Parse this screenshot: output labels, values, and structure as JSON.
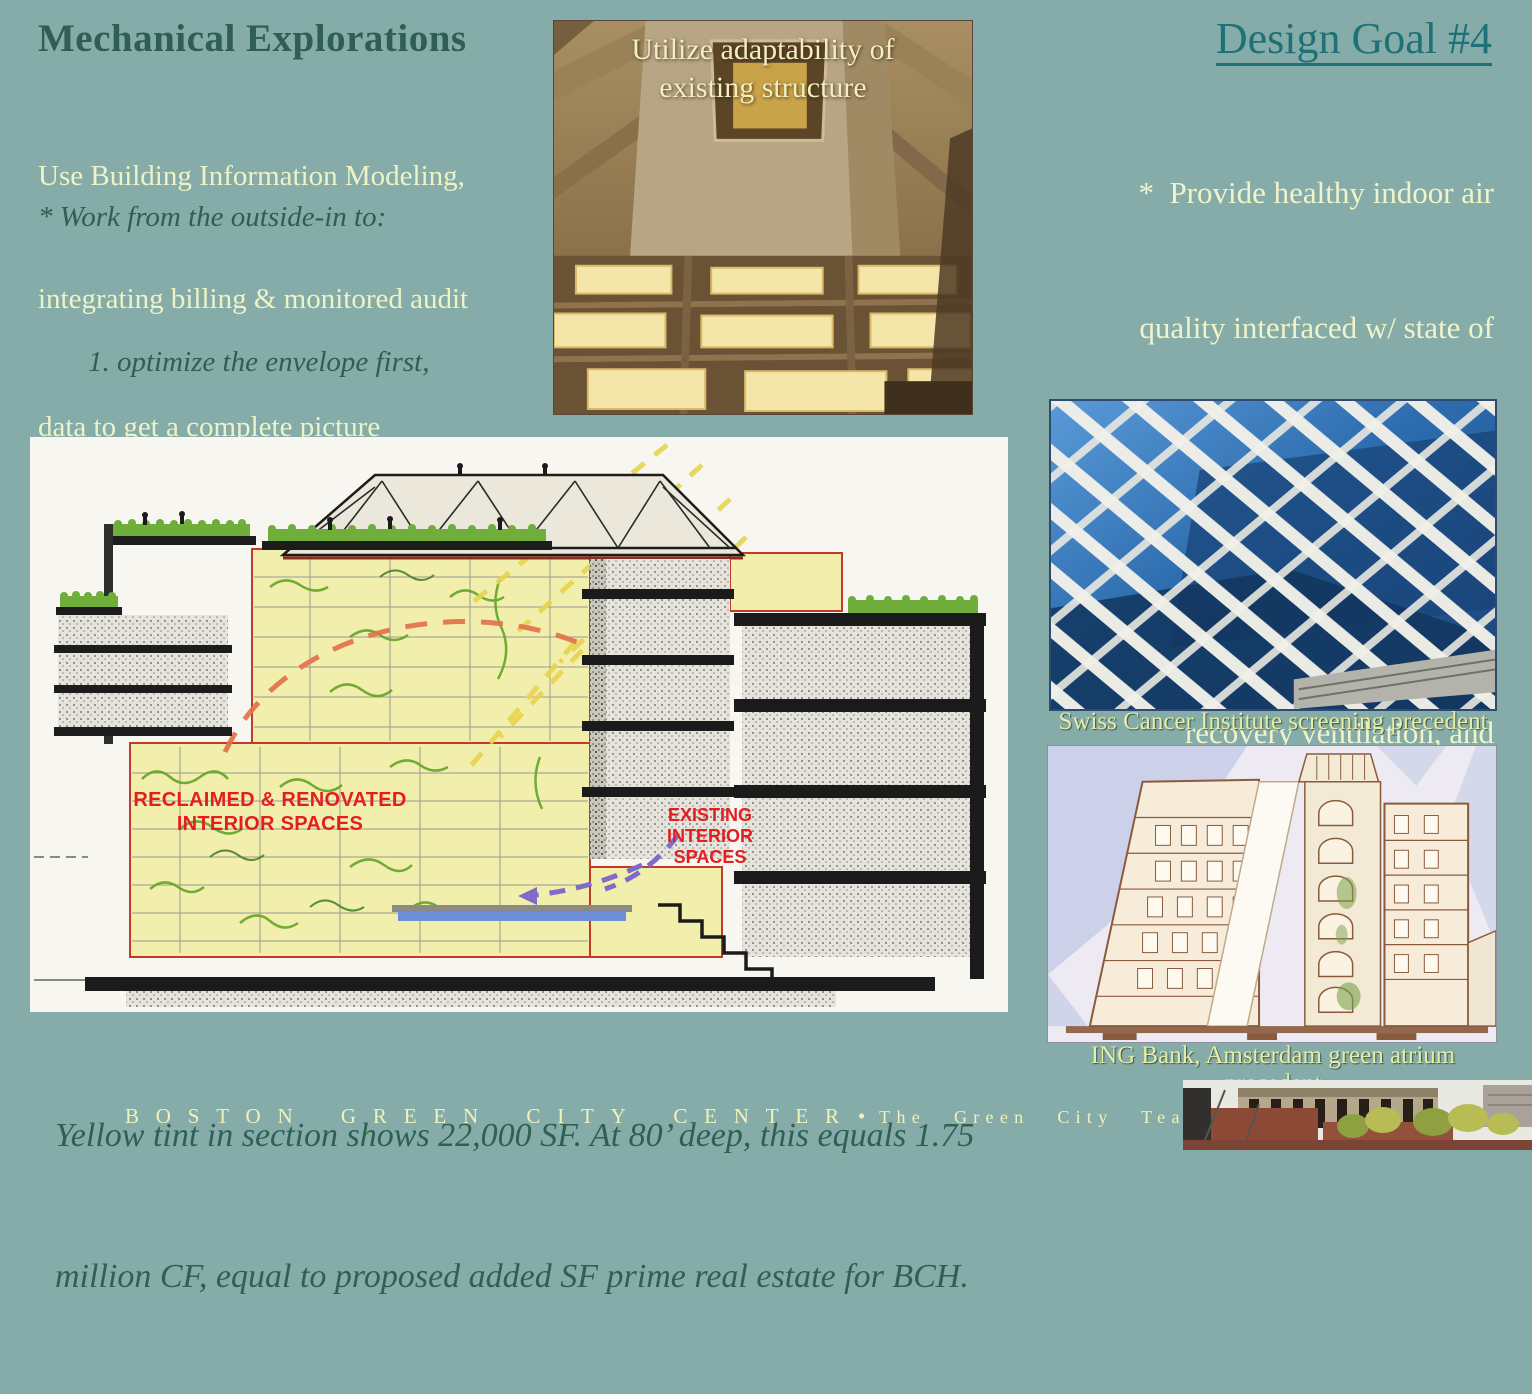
{
  "left_column": {
    "title": "Mechanical Explorations",
    "intro_lines": [
      "Use Building Information Modeling,",
      "integrating billing & monitored audit",
      "data to get a complete picture"
    ],
    "work_note": "* Work from the outside-in to:",
    "list_items": [
      "1. optimize the envelope first,",
      "2.  then lighting,",
      "3. then redesign delivery system,",
      "4.  then equipment."
    ]
  },
  "structure_photo": {
    "caption_lines": [
      "Utilize adaptability of",
      "existing structure"
    ]
  },
  "right_column": {
    "title": "Design Goal #4",
    "body_lines": [
      "*  Provide healthy indoor air",
      "quality interfaced w/ state of",
      "the art mechanical upgrades.",
      "Passive stack effect, heat",
      "recovery ventilation, and",
      "future district heating options",
      "offer synchronistic savings."
    ],
    "swiss_caption": "Swiss Cancer Institute screening precedent",
    "ing_caption": "ING Bank, Amsterdam green atrium precedent"
  },
  "section_drawing": {
    "reclaimed_label_lines": [
      "RECLAIMED & RENOVATED",
      "INTERIOR SPACES"
    ],
    "existing_label_lines": [
      "EXISTING",
      "INTERIOR",
      "SPACES"
    ]
  },
  "bottom_caption_lines": [
    "Yellow tint in section shows 22,000 SF. At 80’ deep, this equals 1.75",
    "million CF, equal to proposed added SF prime real estate for BCH."
  ],
  "footer": {
    "left": "BOSTON GREEN CITY CENTER",
    "separator": "•",
    "right": "The Green City Team"
  },
  "colors": {
    "background": "#86aca9",
    "heading_green": "#2f5e54",
    "body_light_yellow": "#eef3c6",
    "goal_title_teal": "#1e7277",
    "photo_caption_yellow": "#e7eda2",
    "drawing_label_red": "#e41e20",
    "section_tint_yellow": "#f2efad",
    "footer_text": "#f0f2bc"
  }
}
